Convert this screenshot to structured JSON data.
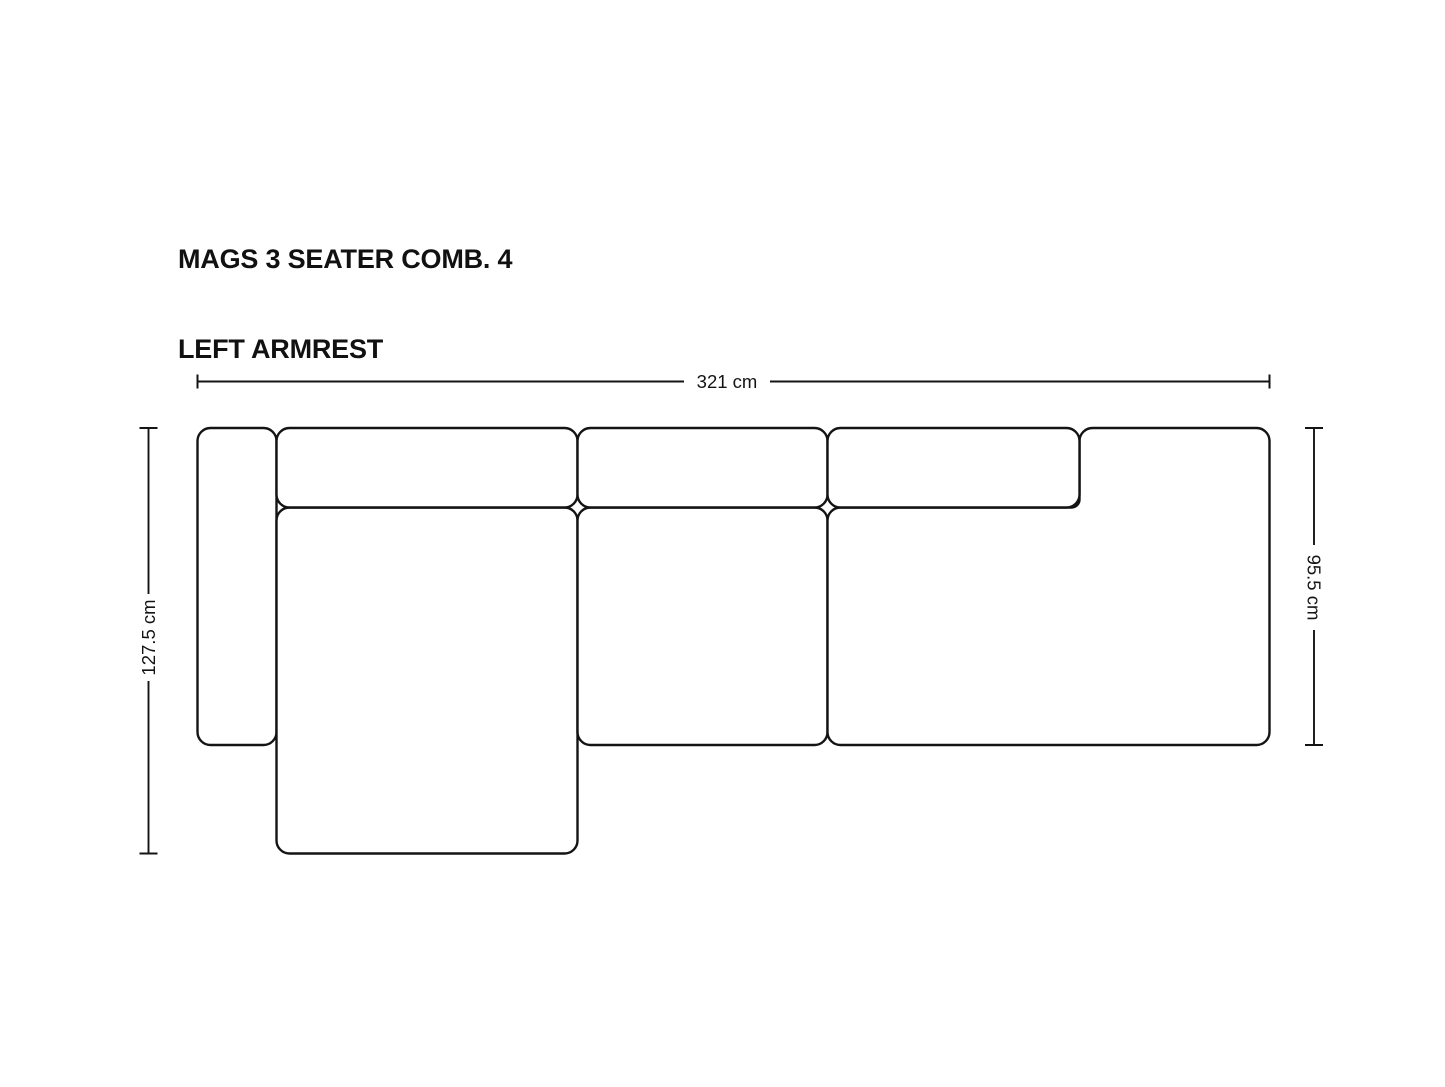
{
  "title": {
    "line1": "MAGS 3 SEATER COMB. 4",
    "line2": "LEFT ARMREST"
  },
  "dimensions": {
    "overall_width": "321 cm",
    "overall_depth": "127.5 cm",
    "seat_depth": "95.5 cm"
  },
  "style": {
    "background": "#ffffff",
    "line_color": "#141414",
    "title_color": "#111111"
  },
  "diagram": {
    "type": "sofa top-view dimension drawing",
    "modules": [
      "left-armrest",
      "back-cushion-1",
      "back-cushion-2",
      "back-cushion-3",
      "chaise-longue",
      "middle-seat",
      "right-corner-seat"
    ]
  }
}
